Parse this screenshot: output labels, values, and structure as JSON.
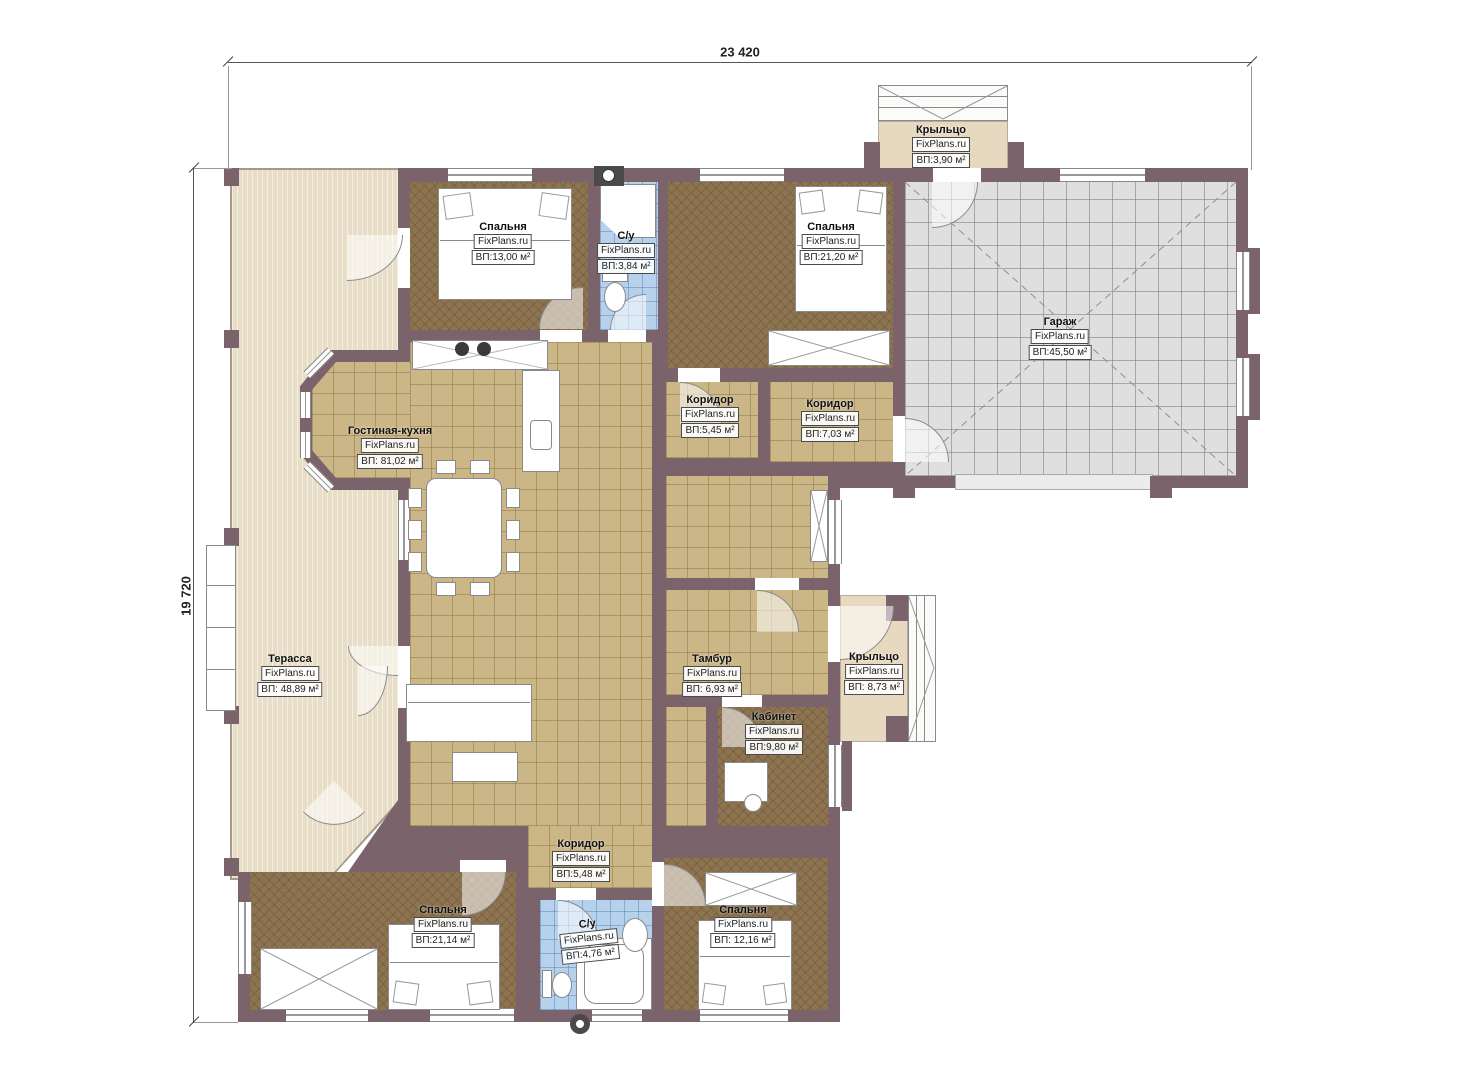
{
  "title": "Floor plan",
  "watermark": "FixPlans.ru",
  "dimensions": {
    "top": "23 420",
    "left": "19 720"
  },
  "colors": {
    "wall": "#7a636a",
    "floor_living": "#cbb687",
    "floor_bedroom": "#8d734f",
    "floor_bathroom": "#b5d1ec",
    "floor_garage": "#dfdfdf",
    "terrace": "#e8ddc6",
    "porch": "#e6d9c0",
    "background": "#ffffff"
  },
  "rooms": [
    {
      "id": "bedroom-top-left",
      "name": "Спальня",
      "area": "ВП:13,00 м²"
    },
    {
      "id": "bathroom-top",
      "name": "С/у",
      "area": "ВП:3,84 м²"
    },
    {
      "id": "bedroom-top-right",
      "name": "Спальня",
      "area": "ВП:21,20 м²"
    },
    {
      "id": "porch-top",
      "name": "Крыльцо",
      "area": "ВП:3,90 м²"
    },
    {
      "id": "garage",
      "name": "Гараж",
      "area": "ВП:45,50 м²"
    },
    {
      "id": "corridor-mid-left",
      "name": "Коридор",
      "area": "ВП:5,45 м²"
    },
    {
      "id": "corridor-mid-right",
      "name": "Коридор",
      "area": "ВП:7,03 м²"
    },
    {
      "id": "living-kitchen",
      "name": "Гостиная-кухня",
      "area": "ВП: 81,02 м²"
    },
    {
      "id": "terrace",
      "name": "Терасса",
      "area": "ВП: 48,89 м²"
    },
    {
      "id": "tambur",
      "name": "Тамбур",
      "area": "ВП: 6,93 м²"
    },
    {
      "id": "porch-right",
      "name": "Крыльцо",
      "area": "ВП: 8,73 м²"
    },
    {
      "id": "kabinet",
      "name": "Кабинет",
      "area": "ВП:9,80 м²"
    },
    {
      "id": "corridor-bottom",
      "name": "Коридор",
      "area": "ВП:5,48 м²"
    },
    {
      "id": "bedroom-bottom-left",
      "name": "Спальня",
      "area": "ВП:21,14 м²"
    },
    {
      "id": "bathroom-bottom",
      "name": "С/у",
      "area": "ВП:4,76 м²"
    },
    {
      "id": "bedroom-bottom-right",
      "name": "Спальня",
      "area": "ВП: 12,16 м²"
    }
  ]
}
